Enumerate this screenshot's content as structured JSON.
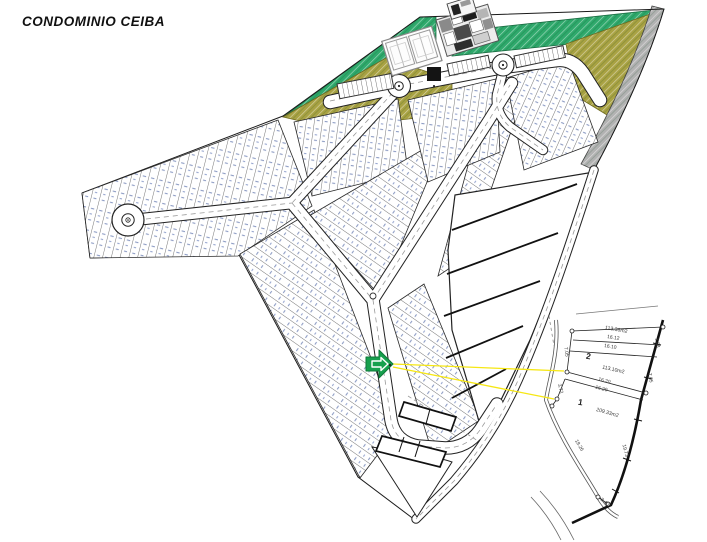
{
  "title": "CONDOMINIO CEIBA",
  "colors": {
    "green_area": "#2fa96c",
    "olive_area": "#a9a243",
    "gray_road": "#b2b2b2",
    "arrow_green": "#17a04e",
    "leader_yellow": "#f6e713"
  },
  "inset": {
    "upper_lot_area": "113.36m2",
    "lots": [
      {
        "number": "2",
        "area": "113.10m2"
      },
      {
        "number": "1",
        "area": "209.33m2"
      }
    ],
    "dims": {
      "top_a": "16.12",
      "top_b": "16.10",
      "mid_a": "16.20",
      "mid_b": "16.29",
      "left_a": "7.05",
      "left_b": "3.72",
      "right_a": "1.88",
      "right_b": "7.05",
      "side_left": "19.26",
      "side_right": "19.73",
      "bottom": "3.40"
    }
  }
}
